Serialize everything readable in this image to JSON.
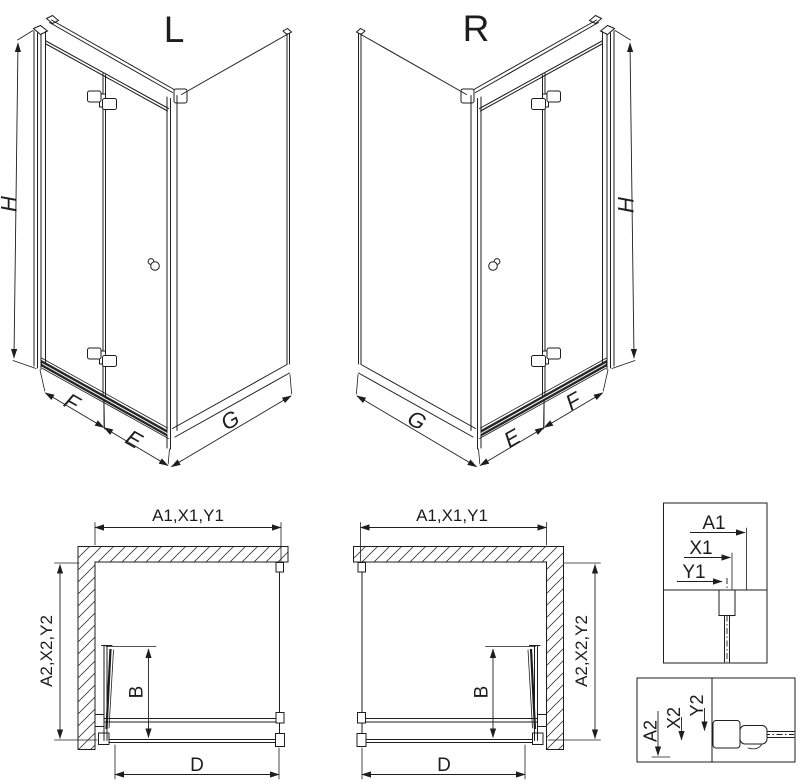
{
  "colors": {
    "line": "#1d1d1d",
    "background": "#ffffff"
  },
  "views": {
    "left_3d": {
      "title": "L",
      "dim_h": "H",
      "dim_f": "F",
      "dim_e": "E",
      "dim_g": "G"
    },
    "right_3d": {
      "title": "R",
      "dim_h": "H",
      "dim_g": "G",
      "dim_e": "E",
      "dim_f": "F"
    },
    "left_plan": {
      "dim_top": "A1,X1,Y1",
      "dim_side": "A2,X2,Y2",
      "dim_b": "B",
      "dim_d": "D"
    },
    "right_plan": {
      "dim_top": "A1,X1,Y1",
      "dim_side": "A2,X2,Y2",
      "dim_b": "B",
      "dim_d": "D"
    },
    "detail_top": {
      "dim_a1": "A1",
      "dim_x1": "X1",
      "dim_y1": "Y1"
    },
    "detail_bottom": {
      "dim_a2": "A2",
      "dim_x2": "X2",
      "dim_y2": "Y2"
    }
  }
}
